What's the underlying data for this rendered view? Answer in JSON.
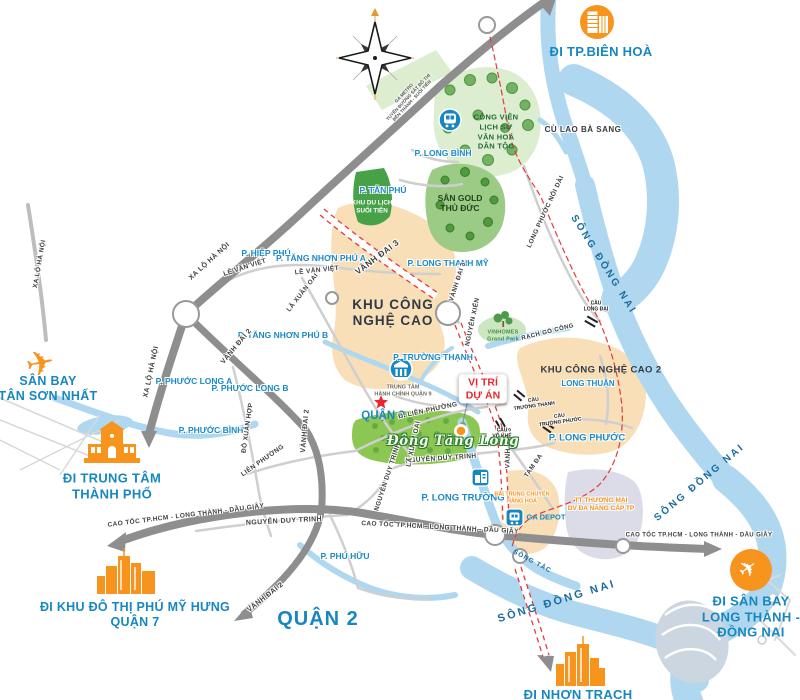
{
  "colors": {
    "accent_blue": "#1787C0",
    "accent_orange": "#F7941E",
    "alert_red": "#E8262D",
    "river_blue": "#AFD8F0",
    "zone_tan": "#F8DFB8",
    "park_green": "#DCEDD0",
    "road_gray": "#8E8E8E",
    "boundary_red": "#E23B3B"
  },
  "callouts": {
    "bien_hoa": {
      "label": "ĐI TP.BIÊN HOÀ"
    },
    "tan_son_nhat": {
      "lines": [
        "SÂN BAY",
        "TÂN SƠN NHẤT"
      ]
    },
    "city_center": {
      "lines": [
        "ĐI TRUNG TÂM",
        "THÀNH PHỐ"
      ]
    },
    "phu_my_hung": {
      "lines": [
        "ĐI KHU ĐÔ THỊ PHÚ MỸ HƯNG",
        "QUẬN 7"
      ]
    },
    "long_thanh_airport": {
      "lines": [
        "ĐI SÂN BAY",
        "LONG THÀNH -",
        "ĐỒNG NAI"
      ]
    },
    "nhon_trach": {
      "label": "ĐI NHƠN TRẠCH"
    }
  },
  "districts": {
    "quan_9": "QUẬN 9",
    "quan_2": "QUẬN 2"
  },
  "zones": {
    "khu_cong_nghe_cao": {
      "lines": [
        "KHU CÔNG",
        "NGHỆ CAO"
      ]
    },
    "khu_cong_nghe_cao_2": {
      "label": "KHU CÔNG NGHỆ CAO 2"
    },
    "cong_vien_lich_su": {
      "lines": [
        "CÔNG VIÊN",
        "LỊCH SỬ",
        "VĂN HOÁ",
        "DÂN TỘC"
      ]
    },
    "san_golf_thu_duc": {
      "lines": [
        "SÂN GOLD",
        "THỦ ĐỨC"
      ]
    },
    "suoi_tien": {
      "lines": [
        "KHU DU LỊCH",
        "SUỐI TIÊN"
      ]
    },
    "cu_lao_ba_sang": {
      "label": "CÙ LAO BÀ SANG"
    }
  },
  "wards": {
    "long_binh": "P. LONG BÌNH",
    "tan_phu": "P. TÂN PHÚ",
    "long_thanh_my": "P. LONG THẠNH MỸ",
    "hiep_phu": "P. HIỆP PHÚ",
    "tang_nhon_phu_a": "P. TĂNG NHƠN PHÚ A",
    "tang_nhon_phu_b": "P. TĂNG NHƠN PHÚ B",
    "truong_thanh": "P. TRƯỜNG THẠNH",
    "phuoc_long_a": "P. PHƯỚC LONG A",
    "phuoc_long_b": "P. PHƯỚC LONG B",
    "phuoc_binh": "P. PHƯỚC BÌNH",
    "long_truong": "P. LONG TRƯỜNG",
    "long_phuoc": "P. LONG PHƯỚC",
    "phu_huu": "P. PHÚ HỮU",
    "long_thuan": "LONG THUẬN"
  },
  "roads": {
    "xa_lo_ha_noi": "XA LỘ HÀ NỘI",
    "vanh_dai_2": "VÀNH ĐAI 2",
    "vanh_dai_3": "VÀNH ĐAI 3",
    "cao_toc": "CAO TỐC TP.HCM - LONG THÀNH - DẦU GIÂY",
    "nguyen_duy_trinh": "NGUYỄN DUY TRINH",
    "le_van_viet": "LÊ VĂN VIỆT",
    "la_xuan_oai": "LÃ XUÂN OAI",
    "do_xuan_hop": "ĐỖ XUÂN HỢP",
    "lien_phuong": "LIÊN PHƯỜNG",
    "d_lien_phuong": "Đ. LIÊN PHƯỜNG",
    "nguyen_xien": "NGUYỄN XIỂN",
    "tam_da": "TAM ĐA",
    "long_phuoc_noi_dai": "LONG PHƯỚC NỐI DÀI",
    "metro_lines": [
      "GA METRO",
      "TUYẾN ĐƯỜNG SẮT ĐÔ THỊ",
      "BẾN THÀNH - SUỐI TIÊN"
    ]
  },
  "rivers": {
    "song_dong_nai": "SÔNG ĐỒNG NAI",
    "song_tac": "SÔNG TẮC",
    "rach_go_cong": "RẠCH GÒ CÔNG"
  },
  "bridges": {
    "cau_long_dai": {
      "lines": [
        "CẦU",
        "LONG ĐẠI"
      ]
    },
    "cau_truong_thanh": {
      "lines": [
        "CẦU",
        "TRƯỜNG THẠNH"
      ]
    },
    "cau_truong_phuoc": {
      "lines": [
        "CẦU",
        "TRƯỜNG PHƯỚC"
      ]
    },
    "cau_vo_khe": {
      "lines": [
        "CẦU",
        "VÕ KHẾ"
      ]
    }
  },
  "pois": {
    "vi_tri_du_an": {
      "lines": [
        "VỊ TRÍ",
        "DỰ ÁN"
      ]
    },
    "dong_tang_long": "Đông Tăng Long",
    "vinhomes": {
      "lines": [
        "VINHOMES",
        "Grand Park"
      ]
    },
    "trung_tam_hanh_chinh": {
      "lines": [
        "TRUNG TÂM",
        "HÀNH CHÍNH QUẬN 9"
      ]
    },
    "ga_depot": "GA DEPOT",
    "bai_trung_chuyen": {
      "lines": [
        "BÃI TRUNG CHUYỂN",
        "HÀNG HOÁ"
      ]
    },
    "tt_thuong_mai": {
      "lines": [
        "TT THƯƠNG MẠI",
        "DV ĐA NĂNG CẤP TP"
      ]
    }
  }
}
